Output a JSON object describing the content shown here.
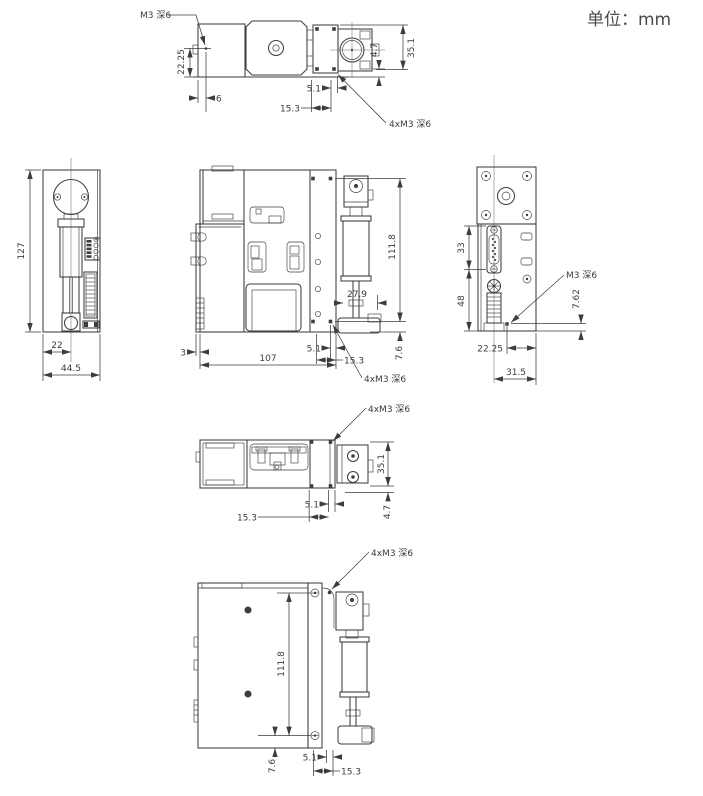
{
  "units_label": "单位：mm",
  "colors": {
    "line": "#3d3d3d",
    "text": "#3c3c3c",
    "background": "#ffffff"
  },
  "views": {
    "top": {
      "dims": {
        "m3_note": "M3 深6",
        "hole_to_bottom": "22.25",
        "hole_to_edge": "6",
        "w5_1": "5.1",
        "w15_3": "15.3",
        "h4_7": "4.7",
        "h35_1": "35.1",
        "m3x4_note": "4xM3 深6"
      }
    },
    "left": {
      "dims": {
        "height": "127",
        "center_offset": "22",
        "width": "44.5"
      }
    },
    "front": {
      "dims": {
        "hole_span": "111.8",
        "syringe_offset": "27.9",
        "step": "3",
        "width": "107",
        "w5_1": "5.1",
        "w15_3": "15.3",
        "h7_6": "7.6",
        "m3x4_note": "4xM3 深6"
      }
    },
    "right": {
      "dims": {
        "h33": "33",
        "h48": "48",
        "m3_note": "M3 深6",
        "h7_62": "7.62",
        "w22_25": "22.25",
        "w31_5": "31.5"
      }
    },
    "rear": {
      "dims": {
        "m3x4_note": "4xM3 深6",
        "h35_1": "35.1",
        "w5_1": "5.1",
        "w15_3": "15.3",
        "h4_7": "4.7"
      }
    },
    "bottom": {
      "dims": {
        "m3x4_note": "4xM3 深6",
        "hole_span": "111.8",
        "h7_6": "7.6",
        "w5_1": "5.1",
        "w15_3": "15.3"
      }
    }
  }
}
